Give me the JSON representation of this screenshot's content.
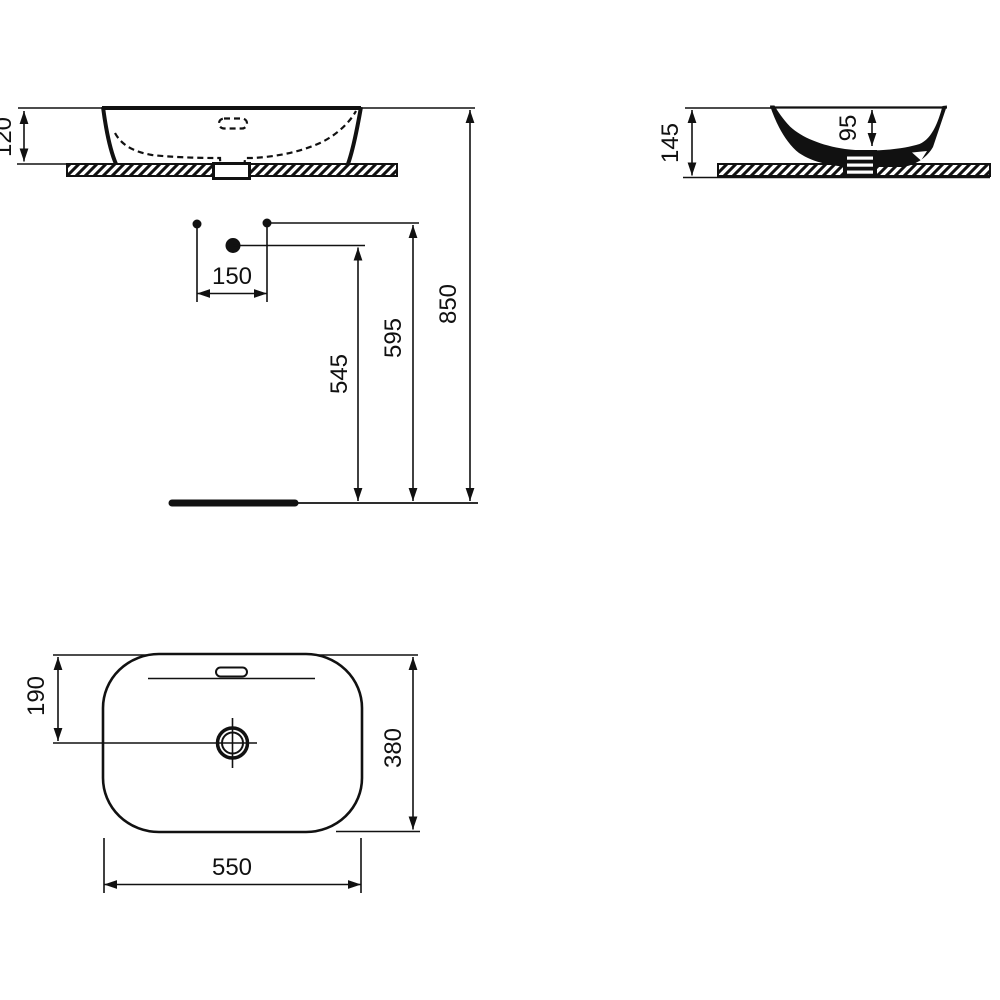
{
  "drawing": {
    "kind": "washbasin technical drawing, three orthographic views with installation dimensions",
    "background_color": "#ffffff",
    "line_color": "#111111"
  },
  "dimensions": {
    "front_rim_to_counter": "120",
    "side_overall_height": "145",
    "side_bowl_depth": "95",
    "hole_spacing": "150",
    "drain_line_height": "545",
    "supply_line_height": "595",
    "rim_height_from_floor": "850",
    "plan_drain_from_top_edge": "190",
    "plan_depth": "380",
    "plan_width": "550"
  }
}
